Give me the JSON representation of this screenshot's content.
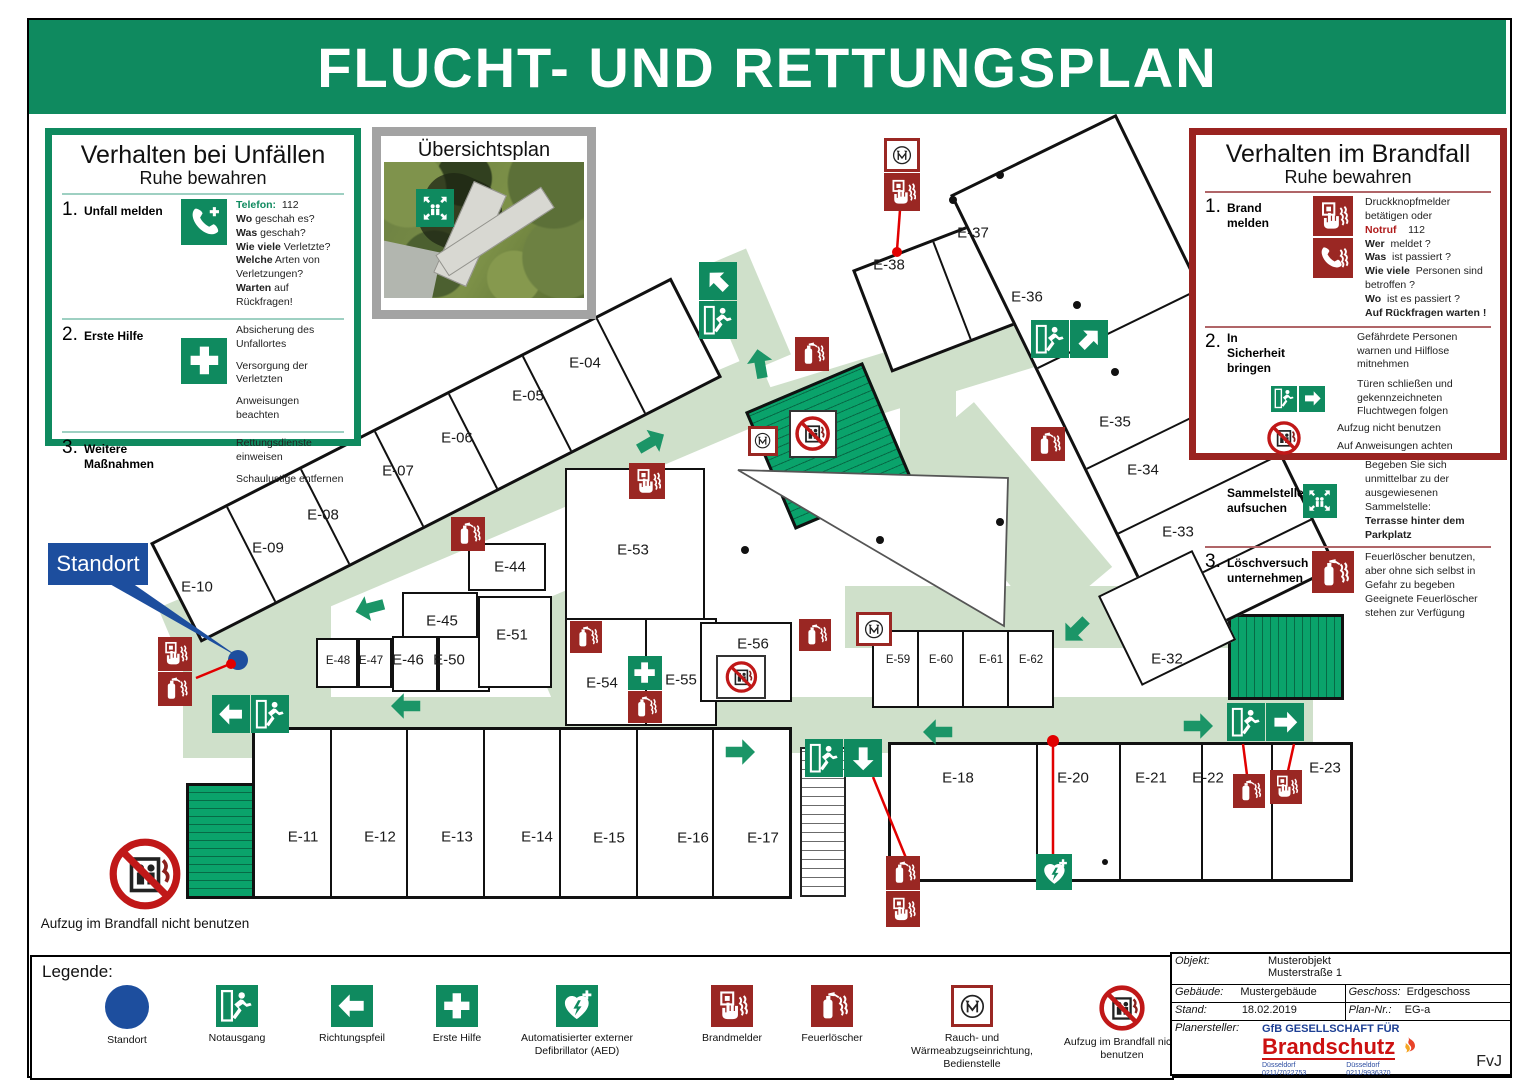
{
  "title": "FLUCHT- UND RETTUNGSPLAN",
  "accident_panel": {
    "title": "Verhalten bei Unfällen",
    "subtitle": "Ruhe bewahren",
    "s1_num": "1.",
    "s1_heading": "Unfall melden",
    "telefon_label": "Telefon:",
    "telefon_number": "112",
    "qa": [
      {
        "q": "Wo",
        "a": "geschah es?"
      },
      {
        "q": "Was",
        "a": "geschah?"
      },
      {
        "q": "Wie viele",
        "a": "Verletzte?"
      },
      {
        "q": "Welche",
        "a": "Arten von Verletzungen?"
      },
      {
        "q": "Warten",
        "a": "auf Rückfragen!"
      }
    ],
    "s2_num": "2.",
    "s2_heading": "Erste Hilfe",
    "s2_items": [
      "Absicherung des Unfallortes",
      "Versorgung der Verletzten",
      "Anweisungen beachten"
    ],
    "s3_num": "3.",
    "s3_heading": "Weitere Maßnahmen",
    "s3_items": [
      "Rettungsdienste einweisen",
      "Schaulustige entfernen"
    ]
  },
  "overview": {
    "title": "Übersichtsplan"
  },
  "fire_panel": {
    "title": "Verhalten im Brandfall",
    "subtitle": "Ruhe bewahren",
    "s1_num": "1.",
    "s1_heading": "Brand melden",
    "s1_line1": "Druckknopfmelder betätigen oder",
    "notruf_label": "Notruf",
    "notruf_number": "112",
    "qa": [
      {
        "q": "Wer",
        "a": "meldet ?"
      },
      {
        "q": "Was",
        "a": "ist passiert ?"
      },
      {
        "q": "Wie viele",
        "a": "Personen sind betroffen ?"
      },
      {
        "q": "Wo",
        "a": "ist es passiert ?"
      }
    ],
    "s1_bold": "Auf Rückfragen warten !",
    "s2_num": "2.",
    "s2_heading": "In Sicherheit bringen",
    "s2_item1": "Gefährdete Personen warnen und Hilflose mitnehmen",
    "s2_item2": "Türen schließen und gekennzeichneten Fluchtwegen folgen",
    "s2_item3": "Aufzug nicht benutzen",
    "s2_item4": "Auf Anweisungen achten",
    "sammel_heading": "Sammelstelle aufsuchen",
    "sammel_text": "Begeben Sie sich unmittelbar zu der ausgewiesenen Sammelstelle:",
    "sammel_bold": "Terrasse hinter dem Parkplatz",
    "s3_num": "3.",
    "s3_heading": "Löschversuch unternehmen",
    "s3_text1": "Feuerlöscher benutzen, aber ohne sich selbst in Gefahr zu begeben",
    "s3_text2": "Geeignete Feuerlöscher stehen zur Verfügung"
  },
  "standort_label": "Standort",
  "elevator_note": "Aufzug im Brandfall nicht benutzen",
  "rooms": [
    "E-04",
    "E-05",
    "E-06",
    "E-07",
    "E-08",
    "E-09",
    "E-10",
    "E-37",
    "E-38",
    "E-36",
    "E-35",
    "E-34",
    "E-33",
    "E-32",
    "E-44",
    "E-45",
    "E-48",
    "E-47",
    "E-46",
    "E-50",
    "E-51",
    "E-53",
    "E-54",
    "E-55",
    "E-56",
    "E-59",
    "E-60",
    "E-61",
    "E-62",
    "E-11",
    "E-12",
    "E-13",
    "E-14",
    "E-15",
    "E-16",
    "E-17",
    "E-18",
    "E-20",
    "E-21",
    "E-22",
    "E-23"
  ],
  "legend": {
    "title": "Legende:",
    "items": [
      "Standort",
      "Notausgang",
      "Richtungspfeil",
      "Erste Hilfe",
      "Automatisierter externer Defibrillator (AED)",
      "Brandmelder",
      "Feuerlöscher",
      "Rauch- und Wärmeabzugseinrichtung, Bedienstelle",
      "Aufzug im Brandfall nicht benutzen"
    ]
  },
  "titleblock": {
    "objekt_label": "Objekt:",
    "objekt1": "Musterobjekt",
    "objekt2": "Musterstraße 1",
    "gebaeude_label": "Gebäude:",
    "gebaeude": "Mustergebäude",
    "geschoss_label": "Geschoss:",
    "geschoss": "Erdgeschoss",
    "stand_label": "Stand:",
    "stand": "18.02.2019",
    "plannr_label": "Plan-Nr.:",
    "plannr": "EG-a",
    "planersteller_label": "Planersteller:",
    "firm_line1": "GfB GESELLSCHAFT FÜR",
    "firm_line2": "Brandschutz",
    "city1": "Düsseldorf",
    "phone1": "0211/7022753",
    "city2": "Düsseldorf",
    "phone2": "0211/9936370",
    "initials": "FvJ"
  },
  "colors": {
    "sign_green": "#0f8a5f",
    "route_green": "#cfe0ca",
    "stair_green": "#0aa36b",
    "alarm_red": "#9a2723",
    "standort_blue": "#1d4e9e"
  }
}
